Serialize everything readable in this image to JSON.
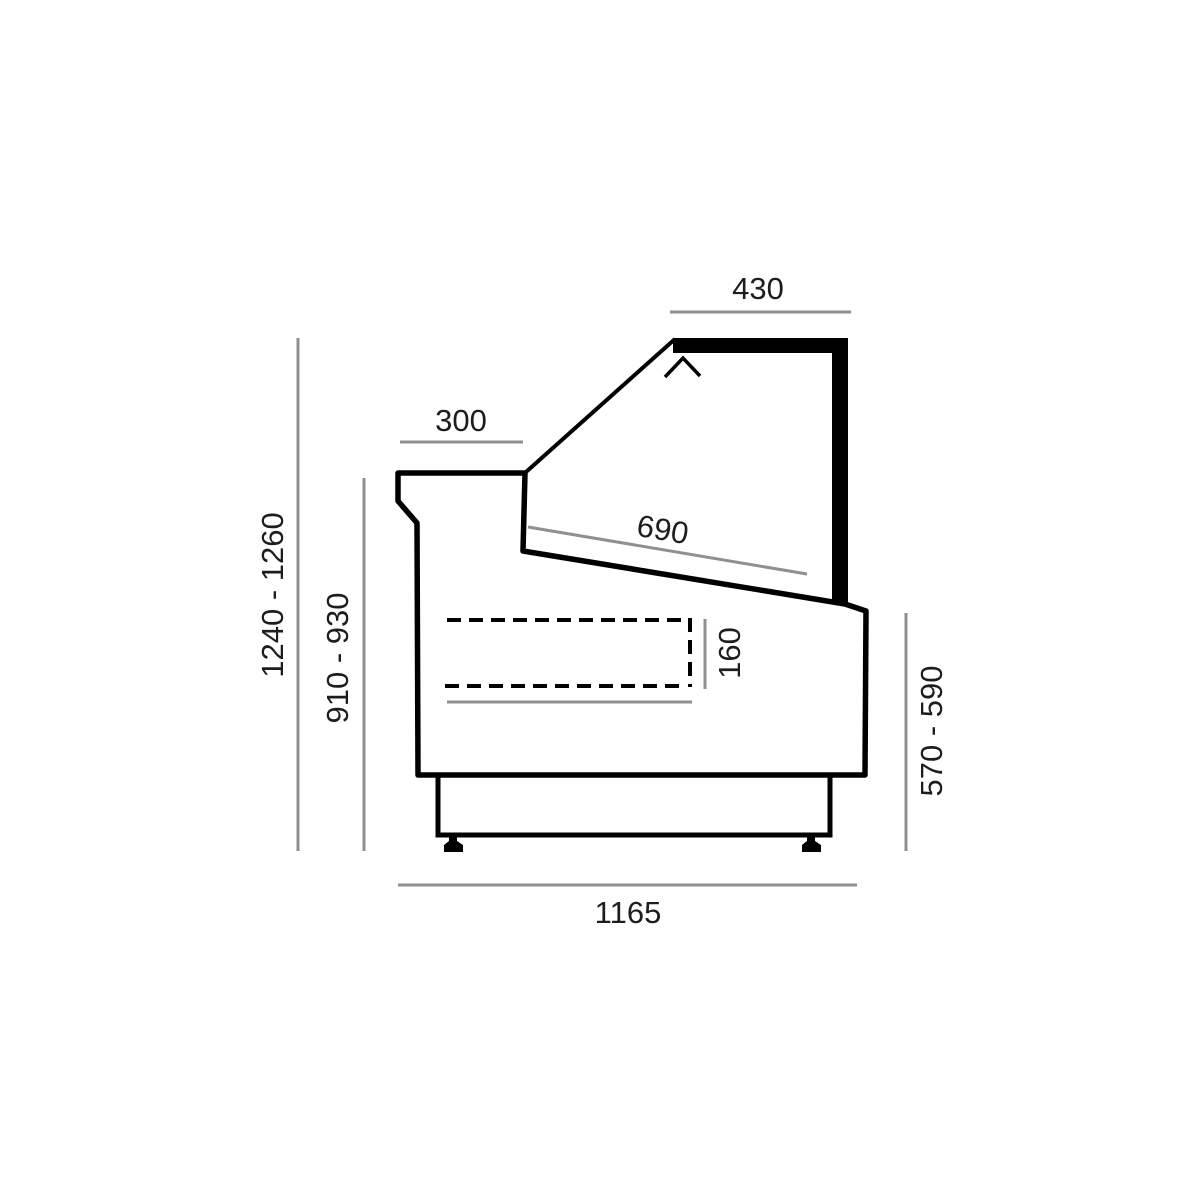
{
  "diagram": {
    "description": "Side cross-section technical drawing of a refrigerated serve-over display counter with dimension lines in millimetres",
    "unit": "mm",
    "colors": {
      "outline": "#000000",
      "dim": "#8f8f8f",
      "text": "#1d1d1b",
      "bg": "#ffffff"
    },
    "labels": {
      "canopy_depth": "430",
      "worktop_depth": "300",
      "deck_length": "690",
      "well_height": "160",
      "overall_height": "1240 - 1260",
      "front_height": "910 - 930",
      "rear_height": "570 - 590",
      "overall_depth": "1165"
    }
  }
}
